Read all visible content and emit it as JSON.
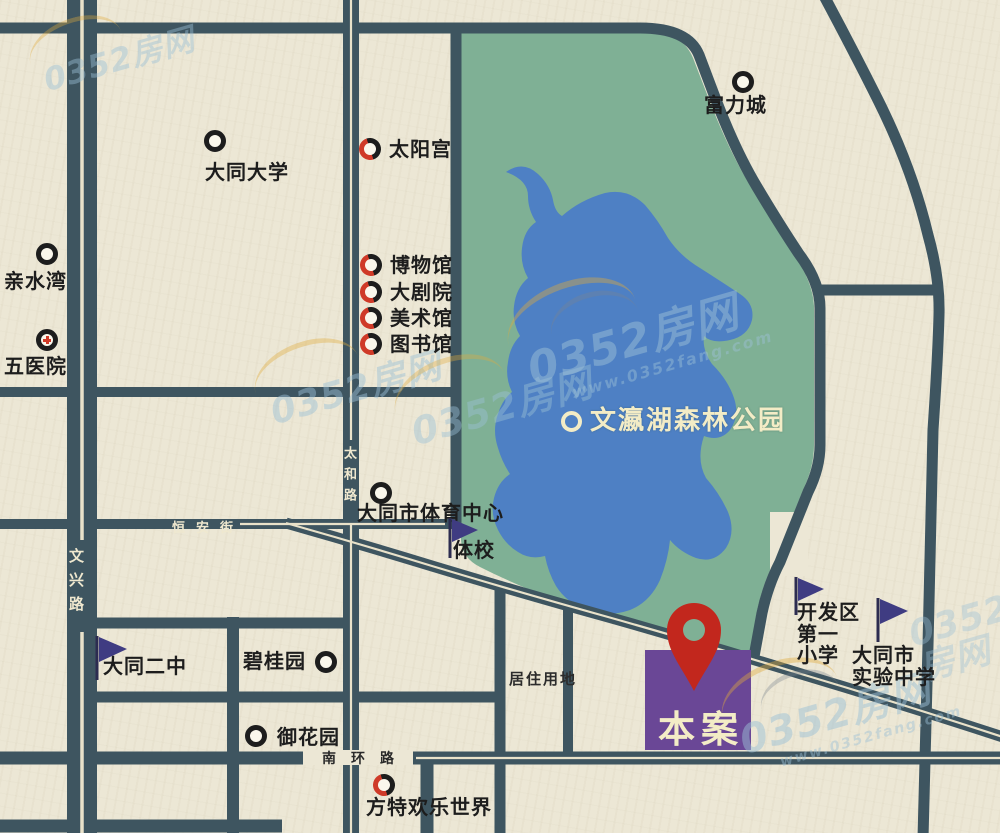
{
  "colors": {
    "background": "#ece7d5",
    "road": "#3e5560",
    "road_stripe": "#e9e2ca",
    "park_green": "#7fb095",
    "lake_blue": "#4e80c4",
    "site_purple": "#6a4796",
    "pin_red": "#c2271d",
    "marker_red": "#cf3a28",
    "marker_black": "#1d1d1d",
    "flag_navy": "#3f3c82",
    "label_cream": "#f3ecc6"
  },
  "site": {
    "label": "本案"
  },
  "park": {
    "label": "文瀛湖森林公园"
  },
  "zone": {
    "label": "居住用地"
  },
  "roads": {
    "wenxing": "文兴路",
    "taihe": "太和路",
    "hengan": "恒安街",
    "nanhuan": "南环路"
  },
  "watermark": {
    "brand": "0352房网",
    "url": "www.0352fang.com"
  },
  "pois": {
    "fulicheng": "富力城",
    "taiyanggong": "太阳宫",
    "datong_univ": "大同大学",
    "qinshuiwan": "亲水湾",
    "wuyiyuan": "五医院",
    "bowuguan": "博物馆",
    "dajuyuan": "大剧院",
    "meishuguan": "美术馆",
    "tushuguan": "图书馆",
    "tiyu_center": "大同市体育中心",
    "tixiao": "体校",
    "erzhong": "大同二中",
    "biguiyuan": "碧桂园",
    "yuhuayuan": "御花园",
    "kaifaqu": "开发区\n第一\n小学",
    "shiyan": "大同市\n实验中学",
    "fangte": "方特欢乐世界"
  }
}
